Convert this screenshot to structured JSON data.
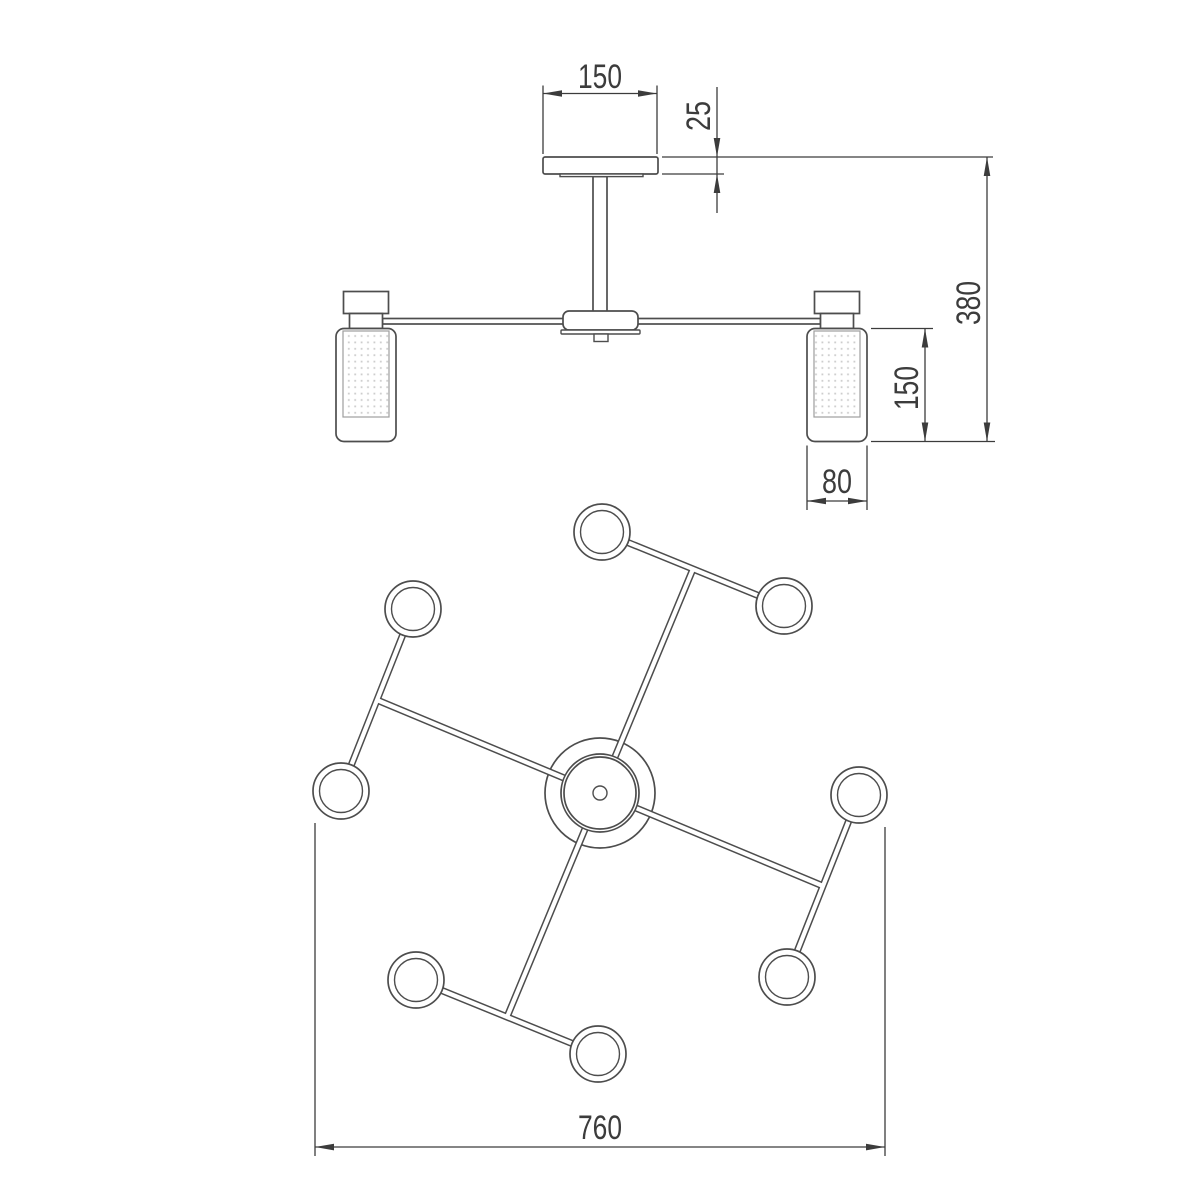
{
  "drawing": {
    "dimensions": {
      "canopy_width": "150",
      "canopy_thickness": "25",
      "overall_height": "380",
      "shade_height": "150",
      "shade_width": "80",
      "overall_width": "760"
    },
    "colors": {
      "line": "#4d4d4d",
      "dimension": "#3c3c3c",
      "diffuser_dot": "#cdcdcd",
      "background": "#ffffff"
    }
  }
}
